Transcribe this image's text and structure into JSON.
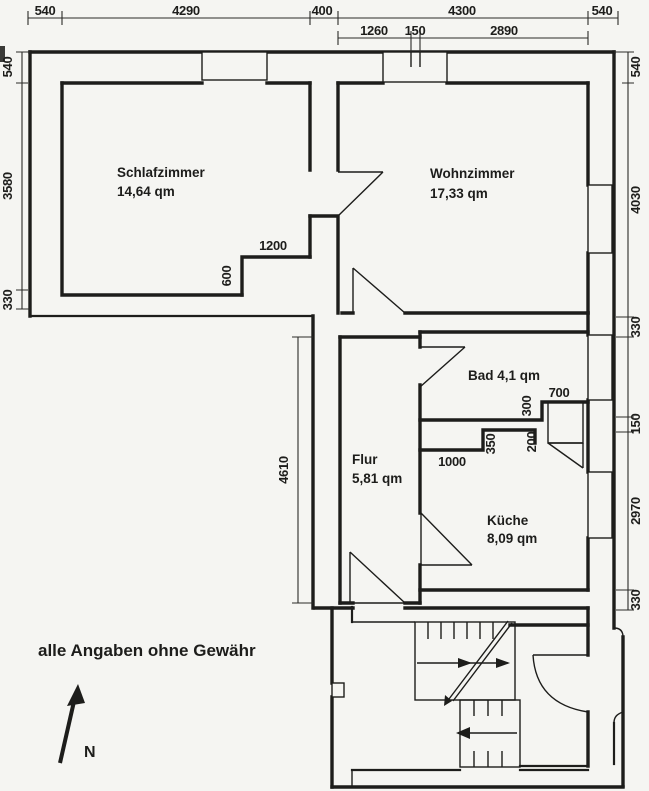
{
  "document": {
    "disclaimer": "alle Angaben ohne Gewähr",
    "compass_label": "N"
  },
  "rooms": {
    "schlafzimmer": {
      "name": "Schlafzimmer",
      "area": "14,64 qm"
    },
    "wohnzimmer": {
      "name": "Wohnzimmer",
      "area": "17,33 qm"
    },
    "bad": {
      "label": "Bad 4,1 qm"
    },
    "flur": {
      "name": "Flur",
      "area": "5,81 qm"
    },
    "kueche": {
      "name": "Küche",
      "area": "8,09 qm"
    }
  },
  "dimensions": {
    "top_row1": [
      "540",
      "4290",
      "400",
      "4300",
      "540"
    ],
    "top_row2": [
      "1260",
      "150",
      "2890"
    ],
    "left": [
      "540",
      "3580",
      "330"
    ],
    "right": [
      "540",
      "4030",
      "330",
      "150",
      "2970",
      "330"
    ],
    "interior": {
      "schlafzimmer_niche_width": "1200",
      "schlafzimmer_niche_depth": "600",
      "flur_length": "4610",
      "bad_alcove_width": "700",
      "bad_alcove_depth": "300",
      "kueche_step_a": "350",
      "kueche_step_b": "200",
      "kueche_wall_length": "1000"
    }
  },
  "colors": {
    "ink": "#1d1d1b",
    "paper": "#f5f5f2"
  }
}
